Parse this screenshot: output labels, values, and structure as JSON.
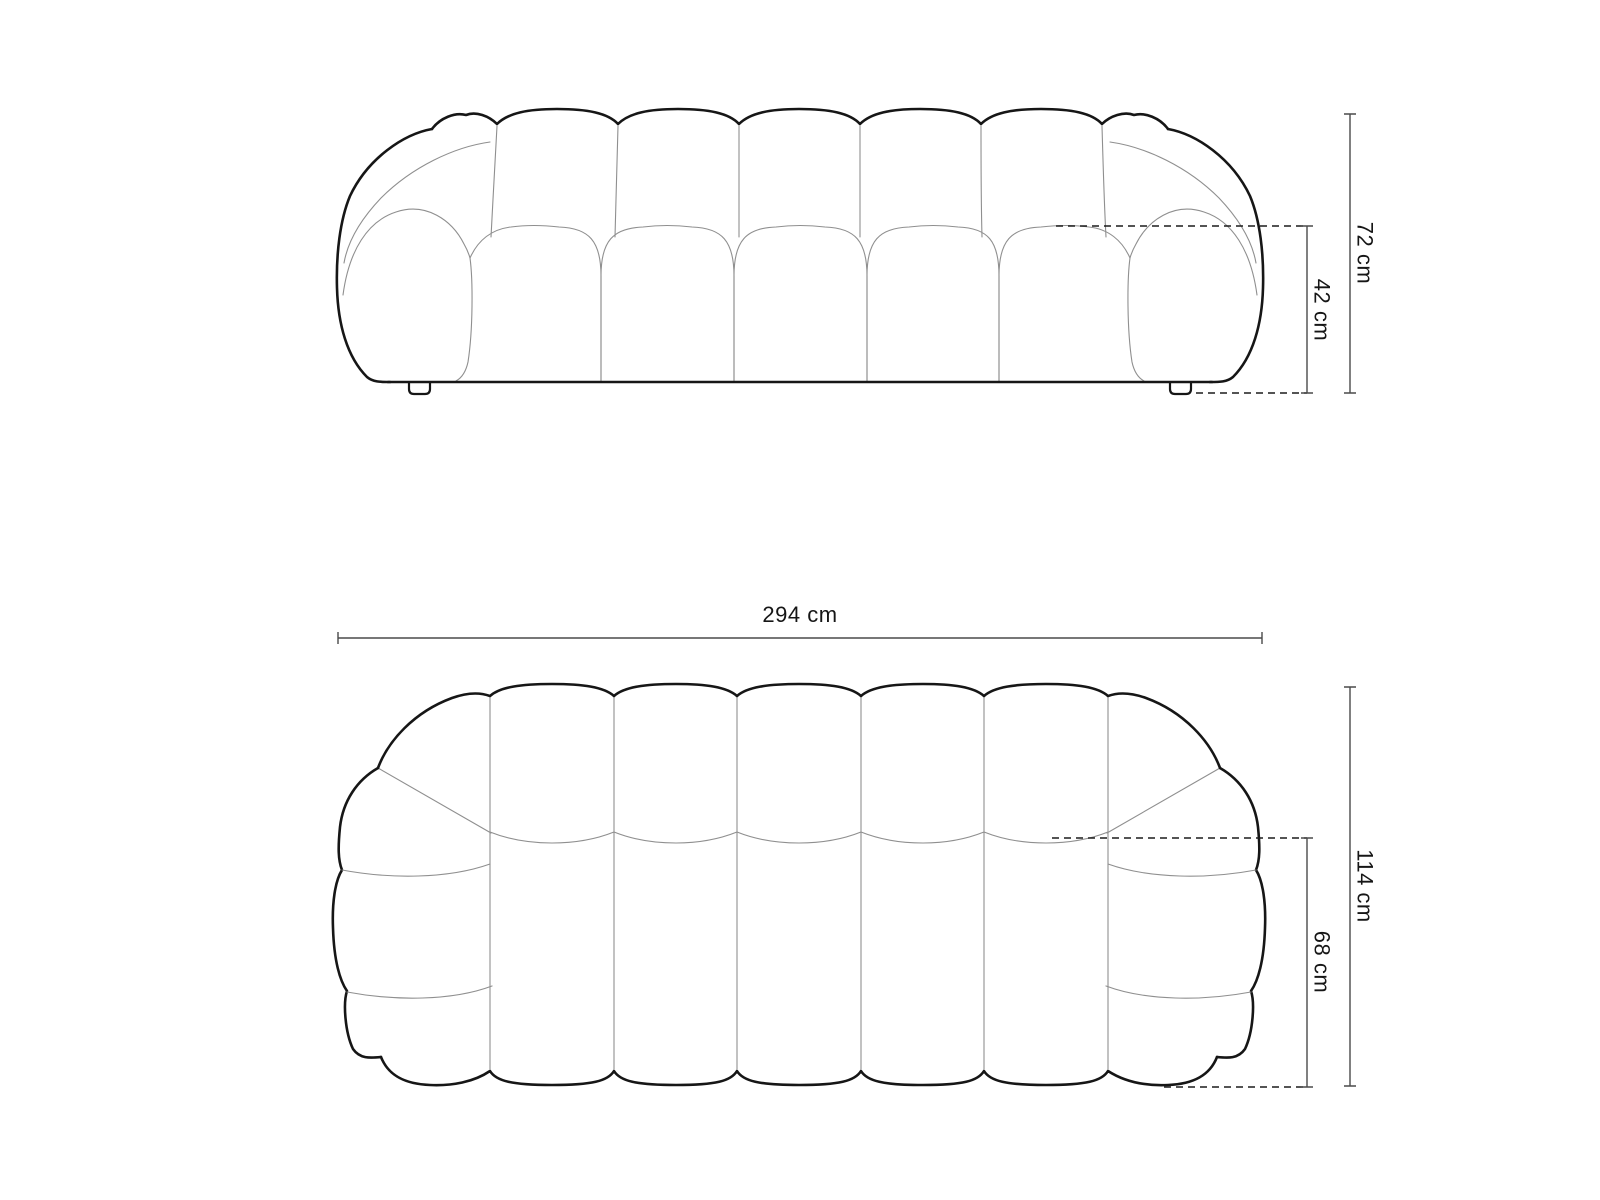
{
  "diagram": {
    "type": "sofa-dimension-drawing",
    "unit": "cm",
    "front_view": {
      "total_height_label": "72 cm",
      "total_height_cm": 72,
      "seat_height_label": "42 cm",
      "seat_height_cm": 42
    },
    "top_view": {
      "total_width_label": "294 cm",
      "total_width_cm": 294,
      "total_depth_label": "114 cm",
      "total_depth_cm": 114,
      "seat_depth_label": "68 cm",
      "seat_depth_cm": 68
    },
    "colors": {
      "outline": "#161616",
      "inner_line": "#8f8f8f",
      "dimension_line": "#4a4a4a",
      "text": "#161616",
      "background": "#ffffff"
    }
  }
}
